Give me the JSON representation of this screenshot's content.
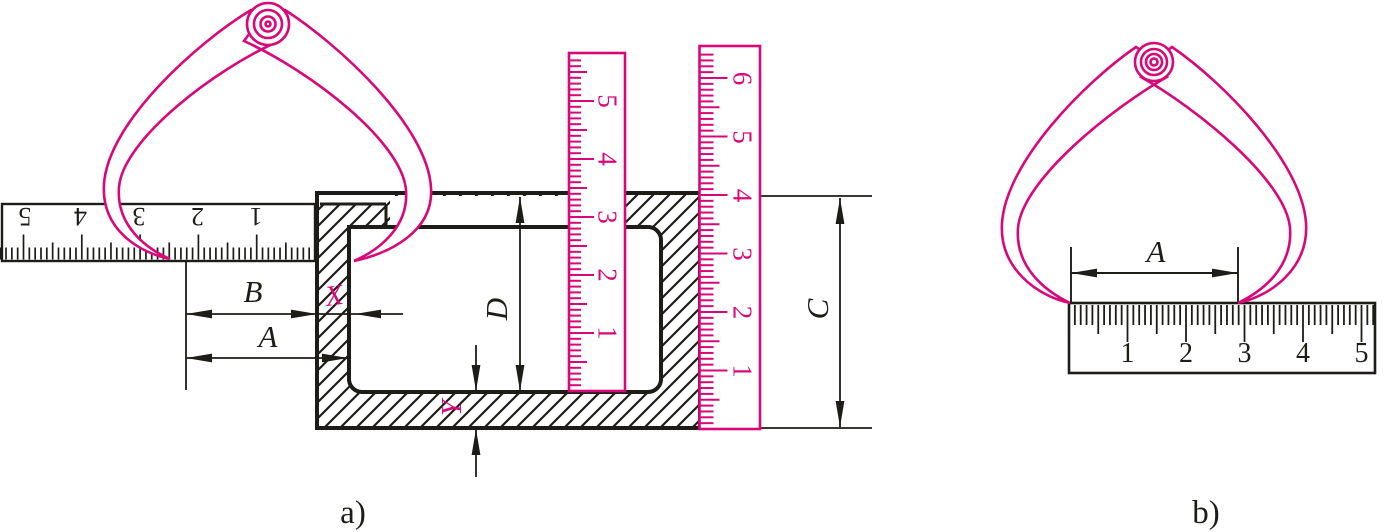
{
  "figure": {
    "label_a": "a)",
    "label_b": "b)"
  },
  "colors": {
    "magenta": "#d90879",
    "ink": "#1d1c17"
  },
  "panel_a": {
    "dim_B": "B",
    "dim_A": "A",
    "dim_X": "X",
    "dim_Y": "Y",
    "dim_D": "D",
    "dim_C": "C"
  },
  "panel_b": {
    "dim_A": "A"
  },
  "rulers": [
    {
      "id": "ruler-a-steel",
      "axis": "x",
      "zero": 315,
      "sign": -1,
      "step": 5.83,
      "count": 54,
      "edge": 259.5,
      "dir": -1,
      "len_mm": 12,
      "len_half": 17,
      "len_cm": 25,
      "stroke": "#1d1c17",
      "w": 1.7,
      "num_off": 217,
      "num_rot": 180,
      "font": 26,
      "num_fill": "#1d1c17",
      "numbers": [
        {
          "t": "5",
          "p": 25
        },
        {
          "t": "4",
          "p": 80.5
        },
        {
          "t": "3",
          "p": 139
        },
        {
          "t": "2",
          "p": 197.5
        },
        {
          "t": "1",
          "p": 256
        }
      ]
    },
    {
      "id": "ruler-a-inner",
      "axis": "y",
      "zero": 391,
      "sign": -1,
      "step": 5.8,
      "count": 57,
      "edge": 570,
      "dir": 1,
      "len_mm": 11,
      "len_half": 17,
      "len_cm": 24,
      "stroke": "#d90879",
      "w": 2,
      "num_off": 608,
      "num_rot": 90,
      "font": 27,
      "num_fill": "#d90879",
      "numbers": [
        {
          "t": "1",
          "p": 333
        },
        {
          "t": "2",
          "p": 275
        },
        {
          "t": "3",
          "p": 217
        },
        {
          "t": "4",
          "p": 159
        },
        {
          "t": "5",
          "p": 101
        }
      ]
    },
    {
      "id": "ruler-a-outer",
      "axis": "y",
      "zero": 429,
      "sign": -1,
      "step": 5.85,
      "count": 64,
      "edge": 700.5,
      "dir": 1,
      "len_mm": 13,
      "len_half": 19,
      "len_cm": 27,
      "stroke": "#d90879",
      "w": 2,
      "num_off": 743,
      "num_rot": 90,
      "font": 27,
      "num_fill": "#d90879",
      "numbers": [
        {
          "t": "1",
          "p": 371
        },
        {
          "t": "2",
          "p": 312.5
        },
        {
          "t": "3",
          "p": 254
        },
        {
          "t": "4",
          "p": 195.5
        },
        {
          "t": "5",
          "p": 137
        },
        {
          "t": "6",
          "p": 78.5
        }
      ]
    },
    {
      "id": "ruler-b",
      "axis": "x",
      "zero": 1069,
      "sign": 1,
      "step": 5.85,
      "count": 52,
      "edge": 305,
      "dir": 1,
      "len_mm": 20,
      "len_half": 29,
      "len_cm": 37,
      "stroke": "#1d1c17",
      "w": 1.8,
      "num_off": 352,
      "num_rot": 0,
      "font": 28,
      "num_fill": "#1d1c17",
      "numbers": [
        {
          "t": "1",
          "p": 1127.5
        },
        {
          "t": "2",
          "p": 1186
        },
        {
          "t": "3",
          "p": 1244.5
        },
        {
          "t": "4",
          "p": 1303
        },
        {
          "t": "5",
          "p": 1361.5
        }
      ]
    }
  ]
}
